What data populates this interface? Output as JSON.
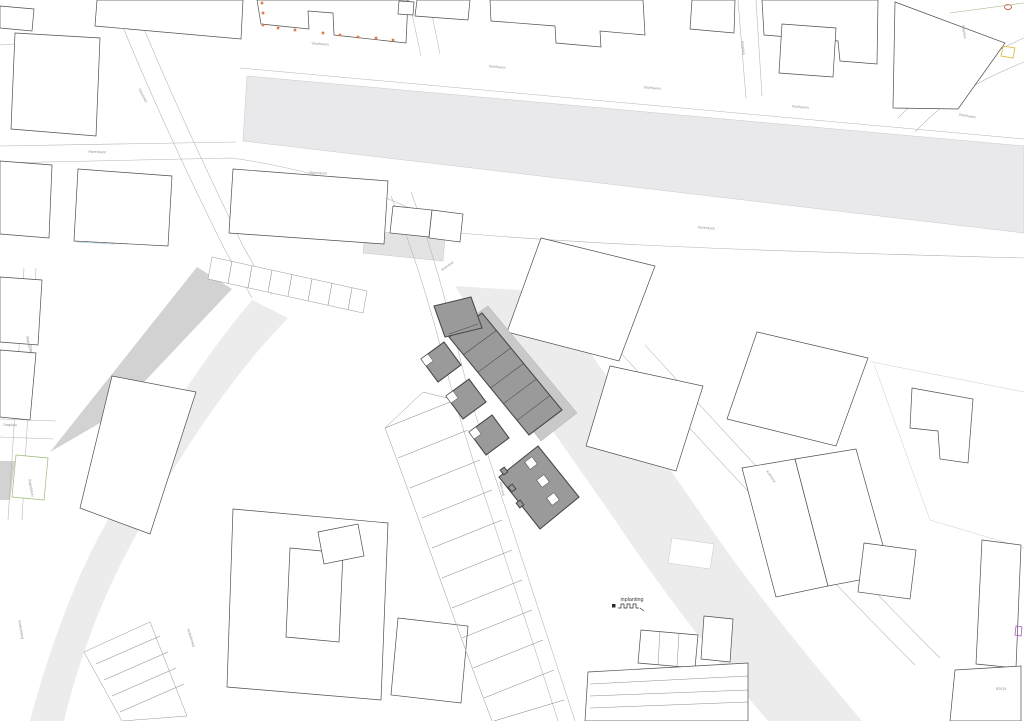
{
  "map": {
    "title_label": {
      "text": "inplanting"
    },
    "scale_bar": {
      "segments": 6
    },
    "street_labels": [
      {
        "text": "Voorhaven",
        "x": 320,
        "y": 45,
        "r": 4
      },
      {
        "text": "Voorhaven",
        "x": 497,
        "y": 68,
        "r": 5
      },
      {
        "text": "Voorhaven",
        "x": 652,
        "y": 89,
        "r": 5
      },
      {
        "text": "Voorhaven",
        "x": 800,
        "y": 108,
        "r": 5
      },
      {
        "text": "Voorhaven",
        "x": 967,
        "y": 117,
        "r": 10
      },
      {
        "text": "Sasstraat",
        "x": 142,
        "y": 96,
        "r": 62
      },
      {
        "text": "Havenkant",
        "x": 97,
        "y": 153,
        "r": 2
      },
      {
        "text": "Havenkant",
        "x": 318,
        "y": 174,
        "r": 4
      },
      {
        "text": "Havenkant",
        "x": 706,
        "y": 229,
        "r": 5
      },
      {
        "text": "Sasplein",
        "x": 742,
        "y": 48,
        "r": 84
      },
      {
        "text": "Sasplein",
        "x": 963,
        "y": 32,
        "r": 80
      },
      {
        "text": "Komvest",
        "x": 448,
        "y": 267,
        "r": -35
      },
      {
        "text": "Komvest",
        "x": 501,
        "y": 489,
        "r": 77
      },
      {
        "text": "Komvest",
        "x": 770,
        "y": 477,
        "r": 55
      },
      {
        "text": "Stapelplein",
        "x": 30,
        "y": 488,
        "r": 80
      },
      {
        "text": "Stapelplein",
        "x": 28,
        "y": 345,
        "r": 78
      },
      {
        "text": "Sasplein",
        "x": 10,
        "y": 426,
        "r": 2
      },
      {
        "text": "Krakeleweg",
        "x": 20,
        "y": 630,
        "r": 80
      },
      {
        "text": "Krakeleweg",
        "x": 190,
        "y": 638,
        "r": 72
      },
      {
        "text": "R2019",
        "x": 1001,
        "y": 690,
        "r": 0
      }
    ],
    "facade_marks": {
      "color": "#d97c4a",
      "points": [
        [
          263,
          25
        ],
        [
          278,
          28
        ],
        [
          295,
          30
        ],
        [
          323,
          33
        ],
        [
          340,
          35
        ],
        [
          358,
          37
        ],
        [
          376,
          38
        ],
        [
          393,
          40
        ],
        [
          262,
          3
        ],
        [
          263,
          13
        ]
      ]
    },
    "special_marks": {
      "red_oval": "#c0392b",
      "yellow_rect": "#d9b92e",
      "purple_rect": "#a55bc0",
      "green_parcel": "#9cb87c",
      "green_line": "#a9b58a",
      "cyan_line": "#bfdde6"
    },
    "colors": {
      "water": "#e9e9eb",
      "ground": "#ececec",
      "ground_dark": "#d2d2d2",
      "building_fill": "#ffffff",
      "building_stroke": "#4f4f4f",
      "project_fill": "#9a9a9a",
      "project_stroke": "#4a4a4a",
      "project_halo": "#c9c9c9",
      "label": "#8f8f8f",
      "mark_orange": "#d97c4a"
    }
  }
}
